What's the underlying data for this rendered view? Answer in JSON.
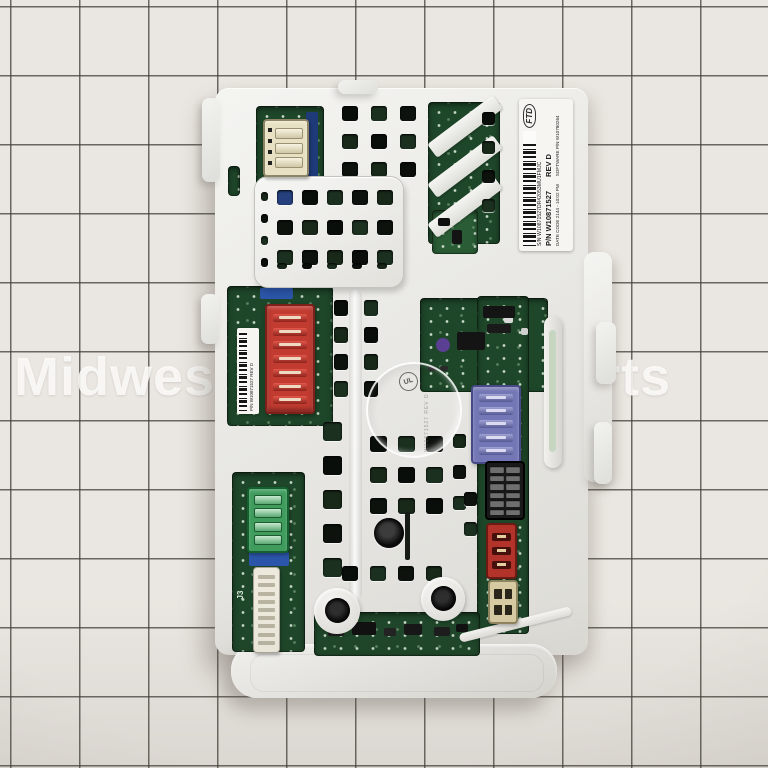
{
  "product": {
    "name": "Laundry washer electronic control board",
    "watermark": "Midwest Appliance Parts"
  },
  "labels": {
    "main": {
      "logo": "FTD",
      "sn": "S/N W10871527DR42053MU1FMJC",
      "pn": "P/N W10871527",
      "rev": "REV D",
      "date_code": "DATE CODE 2144 - 10:02 PM",
      "software_pn": "SOFTWARE P/N W10780264"
    },
    "pcb_small": "P/N W10871527  REV D",
    "silkscreen_j3": "J3",
    "ul_mark": "UL",
    "molded_pn": "W10871527 REV D"
  },
  "connectors": {
    "top_left_cream": {
      "name": "3-slot cream connector",
      "slots": 3,
      "color": "#e7e0c3"
    },
    "red_main": {
      "name": "7-slot red connector",
      "slots": 7,
      "color": "#c23b31"
    },
    "purple": {
      "name": "5-slot purple connector",
      "slots": 5,
      "color": "#7477b5"
    },
    "black_dual": {
      "name": "12-pin black dual-row connector",
      "pins": 12,
      "color": "#191919"
    },
    "red_small": {
      "name": "3-slot small red connector",
      "slots": 3,
      "color": "#b2332a"
    },
    "tan_small": {
      "name": "2-slot tan connector",
      "slots": 2,
      "color": "#d5caa2"
    },
    "green": {
      "name": "4-slot green connector",
      "slots": 4,
      "color": "#3f9c5d"
    },
    "white_header": {
      "name": "9-pin white ribbon header",
      "slots": 9,
      "color": "#edeadd"
    }
  },
  "colors": {
    "paper": "#eae6e1",
    "grid_line": "#4b4843",
    "cover_white": "#ececea",
    "pcb_green": "#1e4629",
    "label_bg": "#f6f5f1",
    "component_blue": "#2b55a8"
  }
}
